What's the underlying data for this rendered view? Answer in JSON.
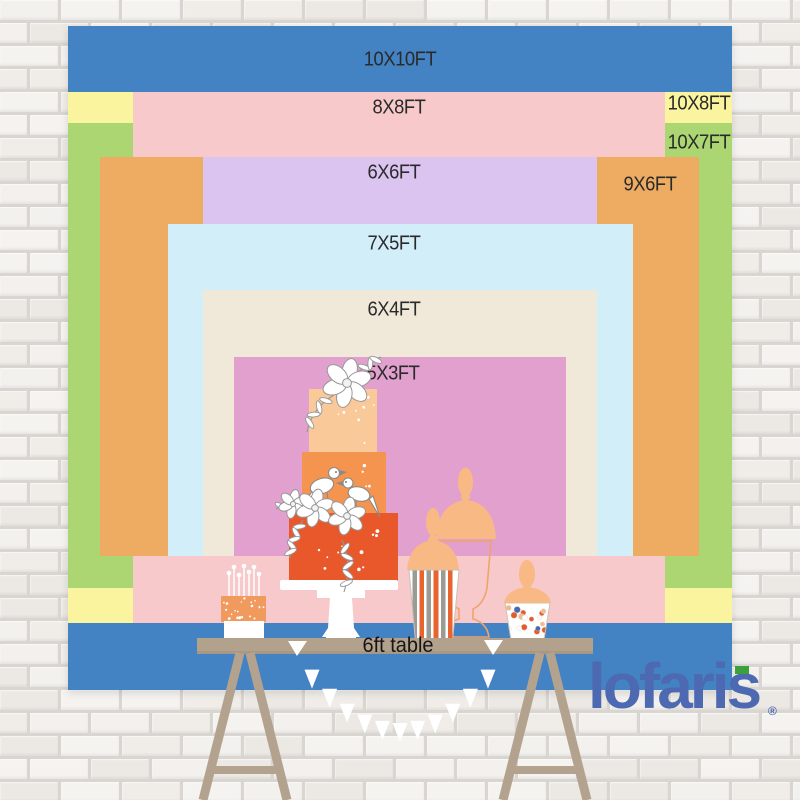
{
  "backdrop": {
    "sizes": [
      {
        "label": "10X10FT",
        "color": "#4383c4"
      },
      {
        "label": "10X8FT",
        "color": "#faf49e"
      },
      {
        "label": "10X7FT",
        "color": "#abd671"
      },
      {
        "label": "8X8FT",
        "color": "#f7c9cb"
      },
      {
        "label": "9X6FT",
        "color": "#eeac62"
      },
      {
        "label": "6X6FT",
        "color": "#dcc4f1"
      },
      {
        "label": "7X5FT",
        "color": "#d2eef8"
      },
      {
        "label": "6X4FT",
        "color": "#f0e9d9"
      },
      {
        "label": "5X3FT",
        "color": "#e1a0cd"
      }
    ],
    "table": {
      "label": "6ft table",
      "color": "#b2a18c"
    }
  },
  "brand": {
    "logo_text": "lofaris",
    "registered_mark": "®",
    "logo_color": "#4d69b2",
    "accent_green": "#3ca03c"
  },
  "illustration": {
    "items": [
      "three-tier-wedding-cake",
      "birthday-cake-with-candles",
      "striped-popcorn-cup",
      "apothecary-jar",
      "candy-jar",
      "trestle-dessert-table",
      "white-bunting-garland",
      "white-brick-wall"
    ],
    "cake_tier_colors": [
      "#fac999",
      "#f4944e",
      "#e9582b"
    ],
    "silhouette_color": "#f8b984"
  }
}
